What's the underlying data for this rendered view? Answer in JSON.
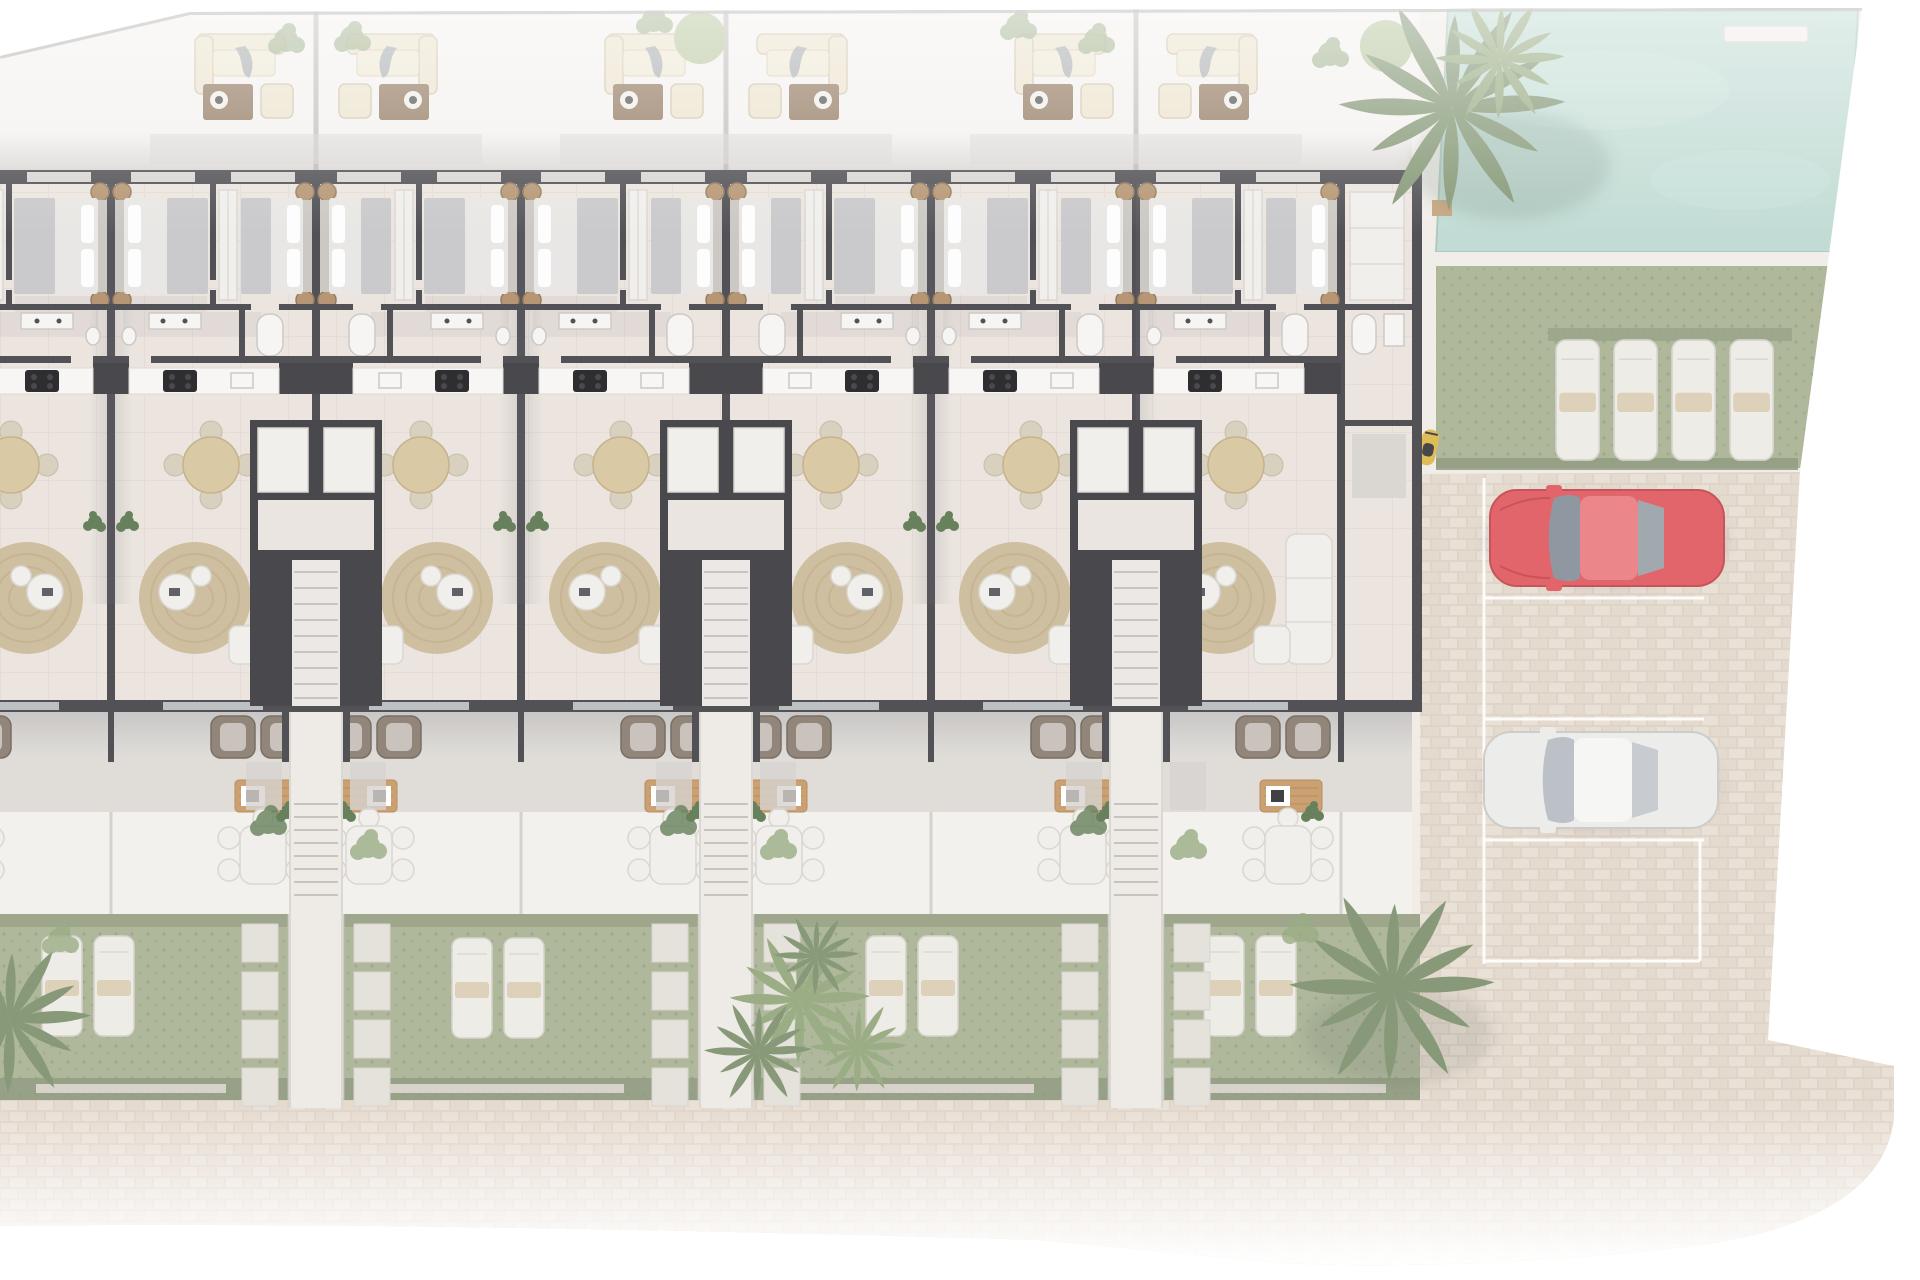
{
  "scene": {
    "type": "architectural-site-plan",
    "view": "top-down 3d rendered floor plan",
    "description": "Ground-floor plan of a row of mirrored two-bedroom residential units with roof terraces above, private gardens with sun loungers below, a communal swimming pool with lawn and sun-lounger deck at the top right, and a paved parking court with vehicles on the right."
  },
  "colors": {
    "wall": "#45454a",
    "wallDark": "#3b3b40",
    "floor": "#ebe4dd",
    "floorRoof": "#f4f2f0",
    "floorTerrace": "#dedbd7",
    "floorPatio": "#f2f0ec",
    "walkLight": "#edeae5",
    "cobbleBase": "#ddd1c5",
    "cobbleA": "#e8ded3",
    "cobbleB": "#e4d8cb",
    "pool": "#bedad2",
    "poolDeck": "#f0ece7",
    "lawn": "#a9b394",
    "lawnDark": "#97a183",
    "hedge": "#8a9478",
    "paver": "#e3dfd9",
    "lounger": "#ecebe6",
    "towel": "#dcceb4",
    "bedding": "#e8e6e3",
    "blanket": "#c6c6c9",
    "headboard": "#c9c5c0",
    "pouf": "#b18f6b",
    "woodLight": "#d8c59f",
    "chairBeige": "#d7cebb",
    "rug": "#c9b692",
    "rugRing": "#b9a57e",
    "sofaWhite": "#f0eeeb",
    "cream": "#ece2cb",
    "creamStroke": "#cfc3a9",
    "tableBrown": "#8d7257",
    "chairBrown": "#8a7d70",
    "wood": "#c79a6a",
    "plantDark": "#5c7850",
    "palm": "#7e926e",
    "palmLight": "#93a77c",
    "treeLight": "#b6c59d",
    "glassDoor": "#ccd1d4",
    "lineLight": "#d6d2cd",
    "carRed": "#e15a61",
    "carRedRoof": "#ea7e83",
    "carGlass": "#87919a",
    "carWhite": "#ebebe9",
    "carWhiteRoof": "#f6f6f4",
    "carGlassLight": "#b6bdc2",
    "parkLine": "#ffffff",
    "scooter": "#ddb94a"
  },
  "building": {
    "visible_units": 7,
    "unit_type": "two-bedroom apartment",
    "rows": [
      "roof terrace with outdoor lounge set",
      "two bedrooms",
      "bathroom",
      "kitchen with cooktop",
      "dining area",
      "living room with round rug and sofa",
      "covered terrace with armchairs",
      "patio with outdoor dining",
      "private garden with two sun loungers"
    ],
    "stairwell_count": 3,
    "garden_walkway_count": 3
  },
  "amenities": {
    "pool": {
      "shape": "rectangular",
      "position": "top-right"
    },
    "pool_lawn_loungers": 4,
    "gardens": 4,
    "loungers_per_garden": 2
  },
  "parking": {
    "marked_spaces": 4,
    "vehicles": [
      {
        "type": "car",
        "color_name": "red",
        "spot": 1
      },
      {
        "type": "car",
        "color_name": "white",
        "spot": 3
      },
      {
        "type": "scooter",
        "color_name": "yellow",
        "spot": "edge of lawn"
      }
    ]
  },
  "vegetation": {
    "palm_trees": 7,
    "round_trees": 2,
    "shrubs": 10
  }
}
